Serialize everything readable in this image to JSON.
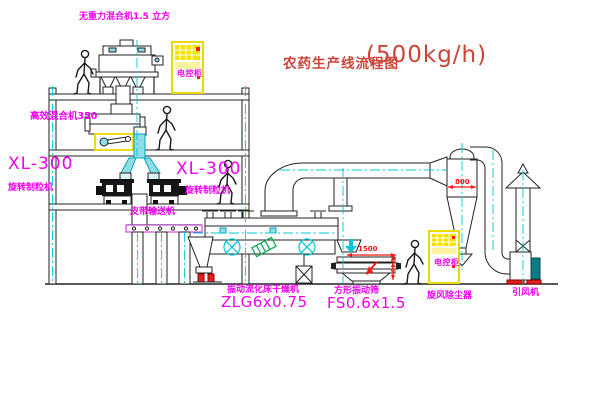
{
  "title": {
    "text": "农药生产线流程图",
    "capacity": "(500kg/h)"
  },
  "labels": {
    "gravity_mixer": "无重力混合机1.5 立方",
    "control_cabinet_1": "电控柜",
    "control_cabinet_2": "电控柜",
    "high_efficiency_mixer": "高效混合机350",
    "granulator_left_model": "XL-300",
    "granulator_left_name": "旋转制粒机",
    "granulator_right_model": "XL-300",
    "granulator_right_name": "旋转制粒机",
    "belt_conveyor": "皮带输送机",
    "dryer_name": "振动流化床干燥机",
    "dryer_model": "ZLG6x0.75",
    "sieve_name": "方形振动筛",
    "sieve_model": "FS0.6x1.5",
    "cyclone_name": "旋风除尘器",
    "fan_name": "引风机"
  },
  "dimensions": {
    "cyclone_inlet_width": "800",
    "sieve_length": "1500",
    "sieve_height": "745"
  },
  "colors": {
    "label_magenta": "#f000f0",
    "title_red": "#cc4438",
    "dimension_red": "#ff1414",
    "cabinet_yellow": "#f2e300",
    "pipe_cyan": "#00c8d7",
    "hatch_green": "#00a550"
  }
}
